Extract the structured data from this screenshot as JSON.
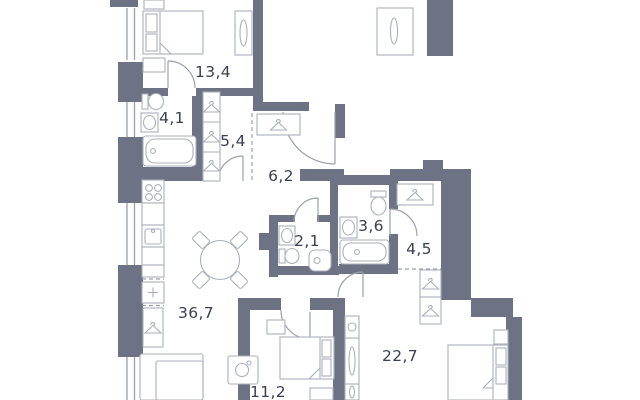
{
  "page": {
    "title": "Apartment floor plan"
  },
  "colors": {
    "wall": "#6d7284",
    "fixture": "#aab0bc",
    "door": "#9aa0ad",
    "window": "#9aa0ad",
    "dashed": "#9aa0ad",
    "label": "#3a4053",
    "background": "#ffffff"
  },
  "rooms": {
    "bedroom_master": {
      "name": "bedroom",
      "area": "13,4"
    },
    "bathroom_ensuite": {
      "name": "bathroom",
      "area": "4,1"
    },
    "hallway_closet": {
      "name": "hallway",
      "area": "5,4"
    },
    "entry_corridor": {
      "name": "entry corridor",
      "area": "6,2"
    },
    "wc": {
      "name": "wc",
      "area": "2,1"
    },
    "bathroom_main": {
      "name": "bathroom",
      "area": "3,6"
    },
    "hall_small": {
      "name": "hall",
      "area": "4,5"
    },
    "living_kitchen": {
      "name": "living-kitchen",
      "area": "36,7"
    },
    "bedroom_small": {
      "name": "bedroom",
      "area": "11,2"
    },
    "bedroom_large": {
      "name": "bedroom",
      "area": "22,7"
    }
  }
}
